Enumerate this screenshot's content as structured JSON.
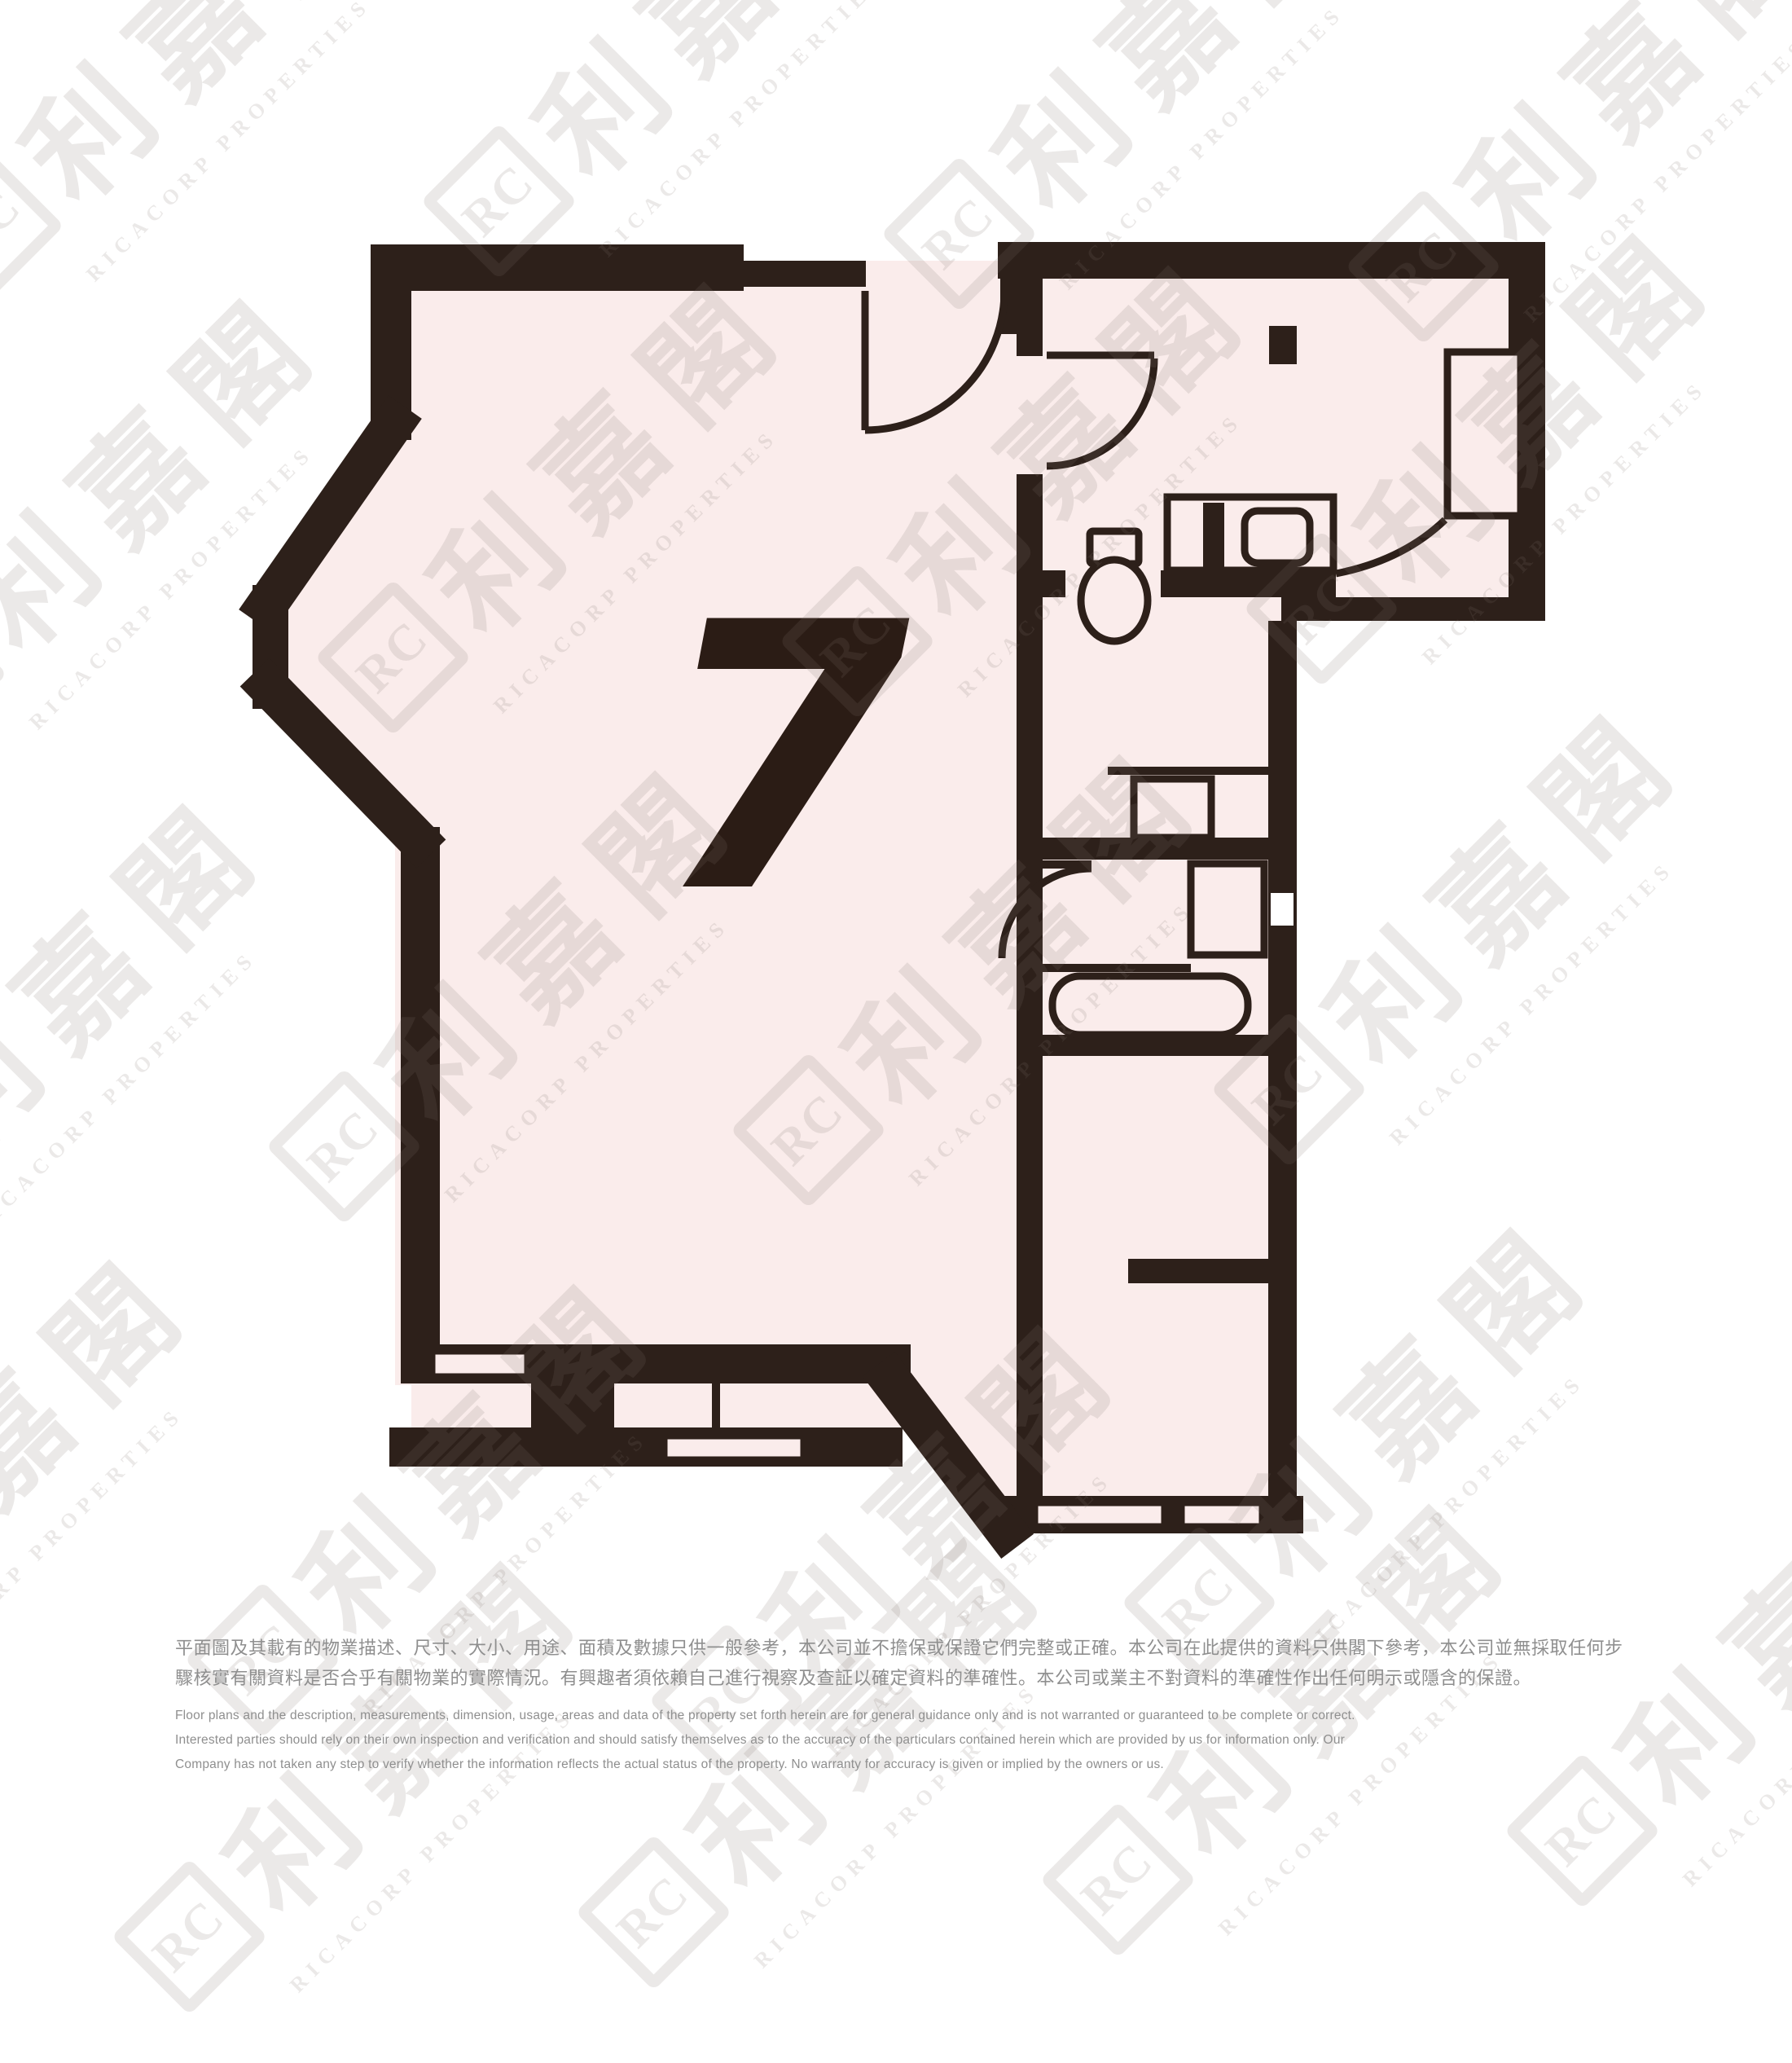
{
  "plan": {
    "unit_label": "7",
    "type": "residential-floor-plan"
  },
  "watermark": {
    "logo_text": "RC",
    "cjk_text": "利嘉閣",
    "latin_text": "RICACORP PROPERTIES"
  },
  "disclaimer": {
    "zh_lines": [
      "平面圖及其載有的物業描述、尺寸、大小、用途、面積及數據只供一般參考，本公司並不擔保或保證它們完整或正確。本公司在此提供的資料只供閣下參考，本公司並無採取任何步",
      "驟核實有關資料是否合乎有關物業的實際情況。有興趣者須依賴自己進行視察及查証以確定資料的準確性。本公司或業主不對資料的準確性作出任何明示或隱含的保證。"
    ],
    "en_lines": [
      "Floor plans and the description, measurements, dimension, usage, areas and data of the property set forth herein are for general guidance only and is not warranted or guaranteed to be complete or correct.",
      "Interested parties should rely on their own inspection and verification and should satisfy themselves as to the accuracy of the particulars contained herein which are provided by us for information only.  Our",
      "Company has not taken any step to verify whether the information reflects the actual status of the property.  No warranty for accuracy is given or implied by the owners or us."
    ]
  },
  "colors": {
    "wall": "#2d201a",
    "room_fill": "#faeceb",
    "watermark": "#e9e6e4",
    "disclaimer_text": "#8f8f8f",
    "background": "#ffffff"
  }
}
